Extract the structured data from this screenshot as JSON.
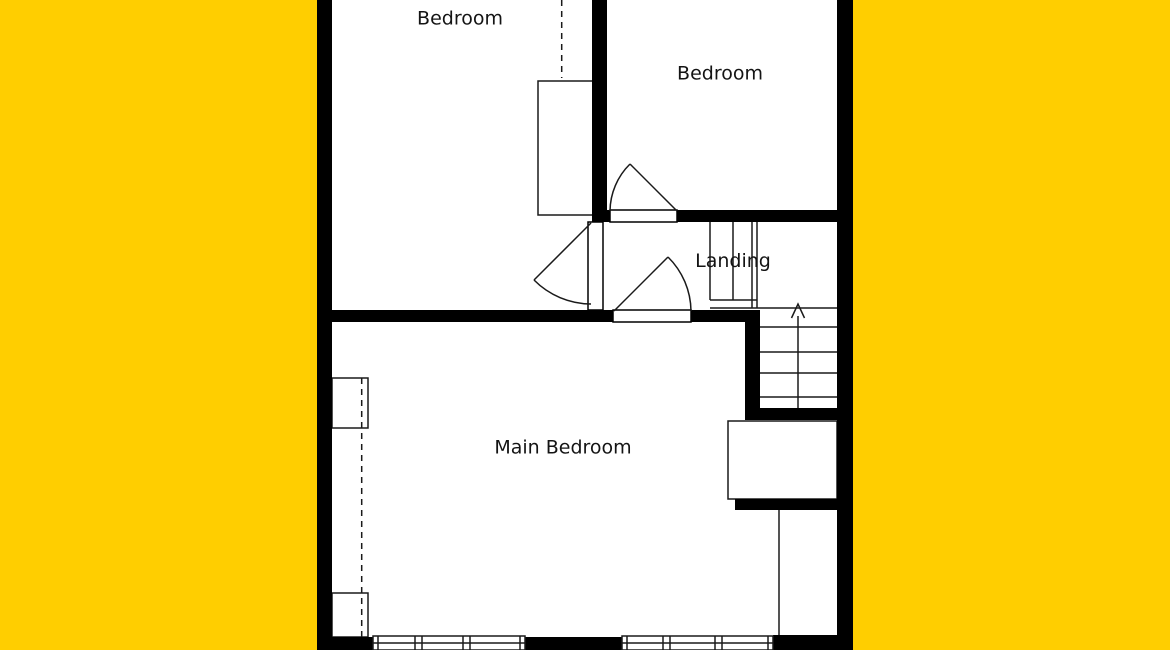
{
  "floor_plan": {
    "rooms": [
      {
        "id": "bedroom-left",
        "label": "Bedroom"
      },
      {
        "id": "bedroom-right",
        "label": "Bedroom"
      },
      {
        "id": "landing",
        "label": "Landing"
      },
      {
        "id": "main-bedroom",
        "label": "Main Bedroom"
      }
    ],
    "stairs": {
      "arrow_direction": "up"
    },
    "feature_icons": [
      "wardrobe-left-bedroom",
      "wardrobe-main-bedroom-top",
      "wardrobe-main-bedroom-bottom",
      "under-stairs-cupboard",
      "door-arc-bedroom-right",
      "door-arc-bedroom-left",
      "door-arc-main-bedroom",
      "window-main-bedroom",
      "window-rear"
    ],
    "colors": {
      "background": "#FFCE00",
      "walls": "#000000",
      "floor": "#FFFFFF",
      "lines": "#1A1A1A",
      "text": "#141414"
    }
  }
}
